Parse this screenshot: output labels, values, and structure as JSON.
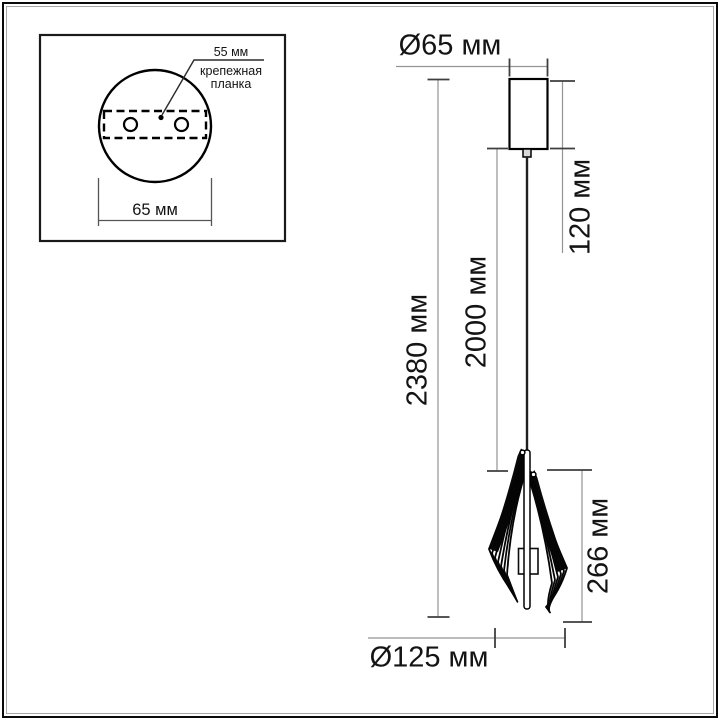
{
  "inset": {
    "plate_offset_label": "55 мм",
    "mounting_plate_line1": "крепежная",
    "mounting_plate_line2": "планка",
    "plate_width_label": "65 мм"
  },
  "main": {
    "canopy_diameter_label": "Ø65 мм",
    "canopy_height_label": "120 мм",
    "cord_length_label": "2000 мм",
    "total_height_label": "2380 мм",
    "shade_height_label": "266 мм",
    "shade_diameter_label": "Ø125 мм"
  },
  "colors": {
    "background": "#ffffff",
    "drawing_line": "#000000",
    "dimension_line": "#949494",
    "tick": "#3f3f3f",
    "text": "#141414"
  }
}
